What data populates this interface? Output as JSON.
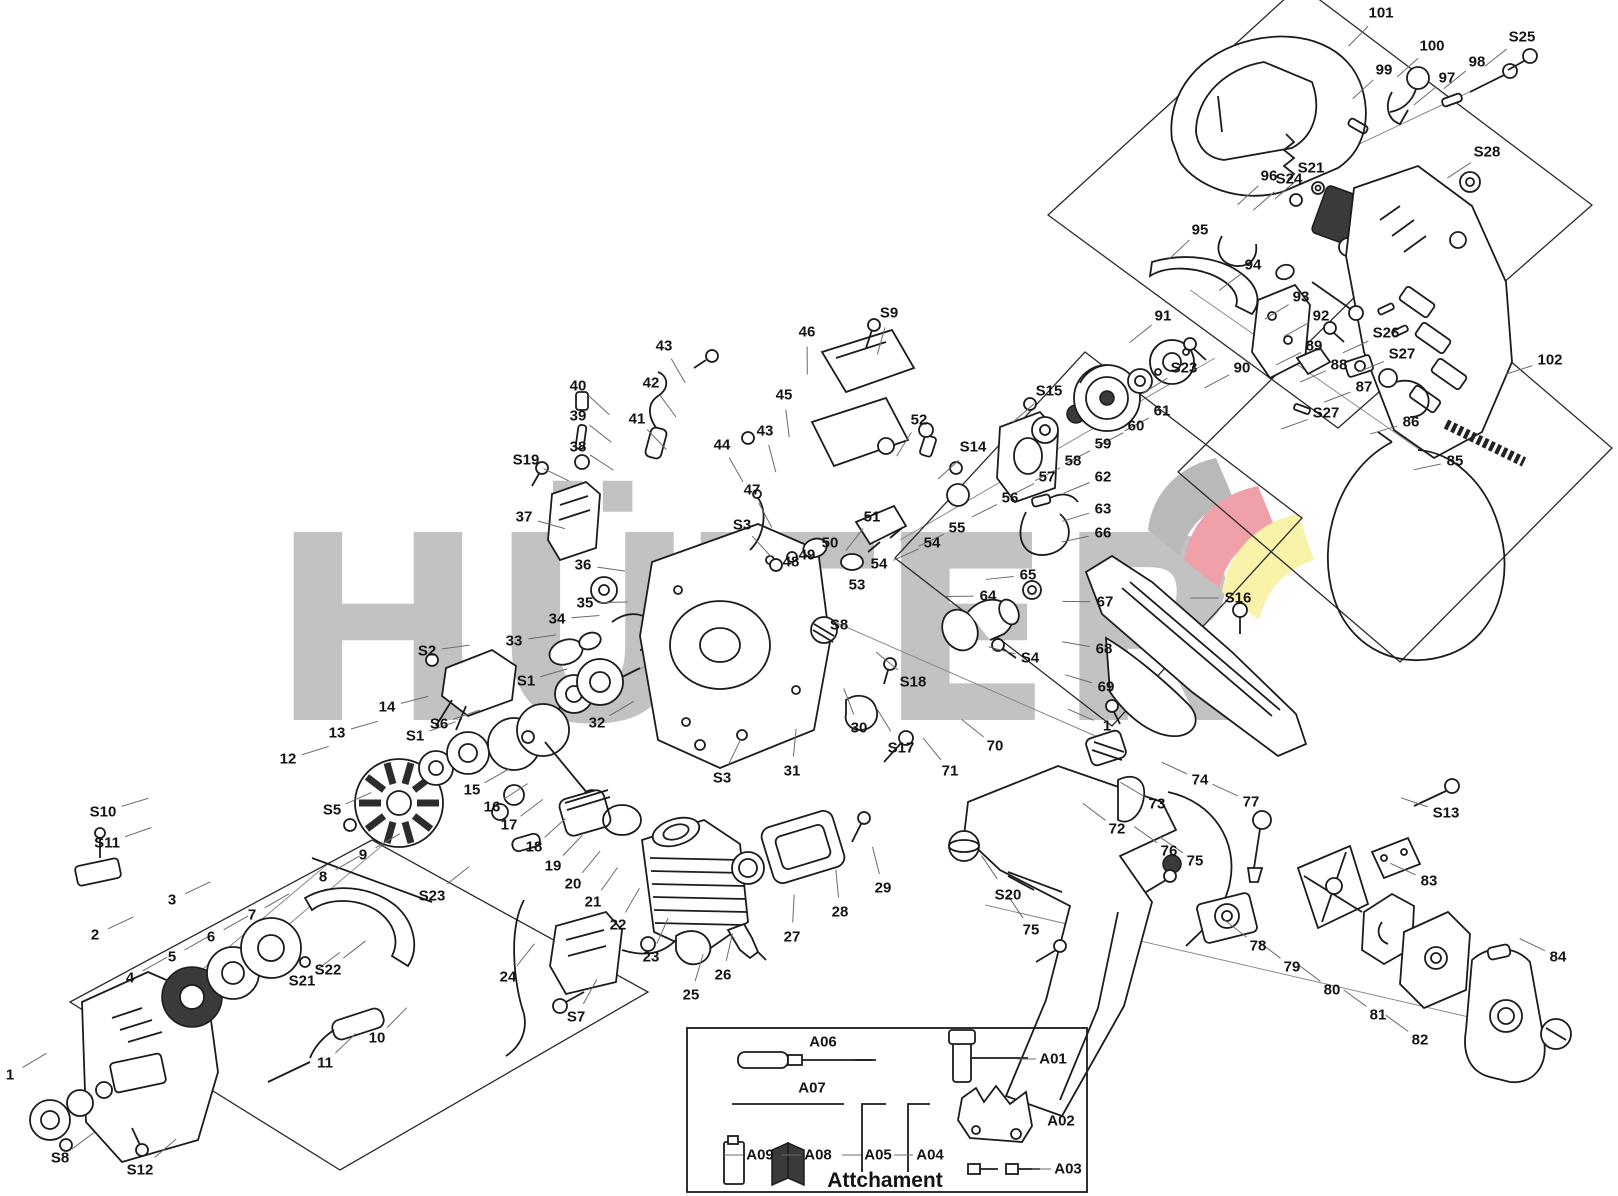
{
  "watermark": {
    "text": "HÜTER"
  },
  "logo": {
    "gray": "#b9b9b9",
    "red": "#efa0a8",
    "yellow": "#f9f2a9"
  },
  "attachment_box": {
    "title": "Attchament"
  },
  "labels": [
    {
      "t": "S10",
      "x": 103,
      "y": 812
    },
    {
      "t": "S11",
      "x": 107,
      "y": 843
    },
    {
      "t": "2",
      "x": 95,
      "y": 935
    },
    {
      "t": "3",
      "x": 172,
      "y": 900
    },
    {
      "t": "4",
      "x": 130,
      "y": 978
    },
    {
      "t": "5",
      "x": 172,
      "y": 957
    },
    {
      "t": "6",
      "x": 211,
      "y": 937
    },
    {
      "t": "7",
      "x": 252,
      "y": 915
    },
    {
      "t": "S21",
      "x": 302,
      "y": 981
    },
    {
      "t": "S22",
      "x": 328,
      "y": 970
    },
    {
      "t": "8",
      "x": 323,
      "y": 877
    },
    {
      "t": "9",
      "x": 363,
      "y": 855
    },
    {
      "t": "S23",
      "x": 432,
      "y": 896
    },
    {
      "t": "10",
      "x": 377,
      "y": 1038
    },
    {
      "t": "11",
      "x": 325,
      "y": 1063
    },
    {
      "t": "1",
      "x": 10,
      "y": 1075
    },
    {
      "t": "S8",
      "x": 60,
      "y": 1158
    },
    {
      "t": "S12",
      "x": 140,
      "y": 1170
    },
    {
      "t": "12",
      "x": 288,
      "y": 759
    },
    {
      "t": "13",
      "x": 337,
      "y": 733
    },
    {
      "t": "S5",
      "x": 332,
      "y": 810
    },
    {
      "t": "14",
      "x": 387,
      "y": 707
    },
    {
      "t": "S2",
      "x": 427,
      "y": 651
    },
    {
      "t": "S6",
      "x": 439,
      "y": 724
    },
    {
      "t": "S1",
      "x": 415,
      "y": 736
    },
    {
      "t": "S1",
      "x": 526,
      "y": 681
    },
    {
      "t": "15",
      "x": 472,
      "y": 790
    },
    {
      "t": "16",
      "x": 492,
      "y": 807
    },
    {
      "t": "17",
      "x": 509,
      "y": 825
    },
    {
      "t": "18",
      "x": 534,
      "y": 847
    },
    {
      "t": "19",
      "x": 553,
      "y": 866
    },
    {
      "t": "20",
      "x": 573,
      "y": 884
    },
    {
      "t": "21",
      "x": 593,
      "y": 902
    },
    {
      "t": "22",
      "x": 618,
      "y": 925
    },
    {
      "t": "23",
      "x": 651,
      "y": 957
    },
    {
      "t": "24",
      "x": 508,
      "y": 977
    },
    {
      "t": "25",
      "x": 691,
      "y": 995
    },
    {
      "t": "S7",
      "x": 576,
      "y": 1017
    },
    {
      "t": "26",
      "x": 723,
      "y": 975
    },
    {
      "t": "27",
      "x": 792,
      "y": 937
    },
    {
      "t": "28",
      "x": 840,
      "y": 912
    },
    {
      "t": "29",
      "x": 883,
      "y": 888
    },
    {
      "t": "32",
      "x": 597,
      "y": 723
    },
    {
      "t": "33",
      "x": 514,
      "y": 641
    },
    {
      "t": "34",
      "x": 557,
      "y": 619
    },
    {
      "t": "35",
      "x": 585,
      "y": 603
    },
    {
      "t": "36",
      "x": 583,
      "y": 565
    },
    {
      "t": "37",
      "x": 524,
      "y": 517
    },
    {
      "t": "S19",
      "x": 526,
      "y": 460
    },
    {
      "t": "38",
      "x": 578,
      "y": 447
    },
    {
      "t": "39",
      "x": 578,
      "y": 416
    },
    {
      "t": "40",
      "x": 578,
      "y": 386
    },
    {
      "t": "41",
      "x": 637,
      "y": 419
    },
    {
      "t": "42",
      "x": 651,
      "y": 383
    },
    {
      "t": "43",
      "x": 664,
      "y": 346
    },
    {
      "t": "44",
      "x": 722,
      "y": 445
    },
    {
      "t": "43",
      "x": 765,
      "y": 431
    },
    {
      "t": "45",
      "x": 784,
      "y": 395
    },
    {
      "t": "46",
      "x": 807,
      "y": 332
    },
    {
      "t": "S9",
      "x": 889,
      "y": 313
    },
    {
      "t": "47",
      "x": 752,
      "y": 490
    },
    {
      "t": "S3",
      "x": 742,
      "y": 525
    },
    {
      "t": "48",
      "x": 791,
      "y": 562
    },
    {
      "t": "49",
      "x": 807,
      "y": 555
    },
    {
      "t": "50",
      "x": 830,
      "y": 543
    },
    {
      "t": "51",
      "x": 872,
      "y": 517
    },
    {
      "t": "53",
      "x": 857,
      "y": 585
    },
    {
      "t": "54",
      "x": 879,
      "y": 564
    },
    {
      "t": "52",
      "x": 919,
      "y": 420
    },
    {
      "t": "S14",
      "x": 973,
      "y": 447
    },
    {
      "t": "54",
      "x": 932,
      "y": 543
    },
    {
      "t": "55",
      "x": 957,
      "y": 528
    },
    {
      "t": "56",
      "x": 1010,
      "y": 498
    },
    {
      "t": "57",
      "x": 1047,
      "y": 477
    },
    {
      "t": "58",
      "x": 1073,
      "y": 461
    },
    {
      "t": "59",
      "x": 1103,
      "y": 444
    },
    {
      "t": "60",
      "x": 1136,
      "y": 426
    },
    {
      "t": "61",
      "x": 1162,
      "y": 411
    },
    {
      "t": "S15",
      "x": 1049,
      "y": 391
    },
    {
      "t": "62",
      "x": 1103,
      "y": 477
    },
    {
      "t": "63",
      "x": 1103,
      "y": 509
    },
    {
      "t": "66",
      "x": 1103,
      "y": 533
    },
    {
      "t": "67",
      "x": 1105,
      "y": 602
    },
    {
      "t": "68",
      "x": 1104,
      "y": 649
    },
    {
      "t": "69",
      "x": 1106,
      "y": 687
    },
    {
      "t": "S16",
      "x": 1238,
      "y": 598
    },
    {
      "t": "64",
      "x": 988,
      "y": 596
    },
    {
      "t": "65",
      "x": 1028,
      "y": 575
    },
    {
      "t": "S4",
      "x": 1030,
      "y": 658
    },
    {
      "t": "S8",
      "x": 839,
      "y": 625
    },
    {
      "t": "S18",
      "x": 913,
      "y": 682
    },
    {
      "t": "30",
      "x": 859,
      "y": 728
    },
    {
      "t": "31",
      "x": 792,
      "y": 771
    },
    {
      "t": "S3",
      "x": 722,
      "y": 778
    },
    {
      "t": "S17",
      "x": 901,
      "y": 748
    },
    {
      "t": "70",
      "x": 995,
      "y": 746
    },
    {
      "t": "71",
      "x": 950,
      "y": 771
    },
    {
      "t": "1",
      "x": 1107,
      "y": 726
    },
    {
      "t": "74",
      "x": 1200,
      "y": 780
    },
    {
      "t": "73",
      "x": 1157,
      "y": 804
    },
    {
      "t": "72",
      "x": 1117,
      "y": 829
    },
    {
      "t": "77",
      "x": 1251,
      "y": 802
    },
    {
      "t": "76",
      "x": 1169,
      "y": 851
    },
    {
      "t": "75",
      "x": 1195,
      "y": 861
    },
    {
      "t": "S20",
      "x": 1008,
      "y": 895
    },
    {
      "t": "75",
      "x": 1031,
      "y": 930
    },
    {
      "t": "78",
      "x": 1258,
      "y": 946
    },
    {
      "t": "79",
      "x": 1292,
      "y": 967
    },
    {
      "t": "80",
      "x": 1332,
      "y": 990
    },
    {
      "t": "81",
      "x": 1378,
      "y": 1015
    },
    {
      "t": "82",
      "x": 1420,
      "y": 1040
    },
    {
      "t": "84",
      "x": 1558,
      "y": 957
    },
    {
      "t": "S13",
      "x": 1446,
      "y": 813
    },
    {
      "t": "83",
      "x": 1429,
      "y": 881
    },
    {
      "t": "101",
      "x": 1381,
      "y": 13
    },
    {
      "t": "99",
      "x": 1384,
      "y": 70
    },
    {
      "t": "100",
      "x": 1432,
      "y": 46
    },
    {
      "t": "97",
      "x": 1447,
      "y": 78
    },
    {
      "t": "98",
      "x": 1477,
      "y": 62
    },
    {
      "t": "S25",
      "x": 1522,
      "y": 37
    },
    {
      "t": "S28",
      "x": 1487,
      "y": 152
    },
    {
      "t": "96",
      "x": 1269,
      "y": 176
    },
    {
      "t": "S24",
      "x": 1289,
      "y": 179
    },
    {
      "t": "S21",
      "x": 1311,
      "y": 168
    },
    {
      "t": "95",
      "x": 1200,
      "y": 230
    },
    {
      "t": "94",
      "x": 1253,
      "y": 265
    },
    {
      "t": "93",
      "x": 1301,
      "y": 297
    },
    {
      "t": "92",
      "x": 1321,
      "y": 316
    },
    {
      "t": "S26",
      "x": 1386,
      "y": 333
    },
    {
      "t": "S27",
      "x": 1402,
      "y": 354
    },
    {
      "t": "91",
      "x": 1163,
      "y": 316
    },
    {
      "t": "S23",
      "x": 1184,
      "y": 368
    },
    {
      "t": "90",
      "x": 1242,
      "y": 368
    },
    {
      "t": "89",
      "x": 1314,
      "y": 346
    },
    {
      "t": "88",
      "x": 1339,
      "y": 365
    },
    {
      "t": "87",
      "x": 1364,
      "y": 387
    },
    {
      "t": "S27",
      "x": 1326,
      "y": 413
    },
    {
      "t": "86",
      "x": 1411,
      "y": 422
    },
    {
      "t": "85",
      "x": 1455,
      "y": 461
    },
    {
      "t": "102",
      "x": 1550,
      "y": 360
    },
    {
      "t": "A06",
      "x": 823,
      "y": 1042,
      "lead": "n"
    },
    {
      "t": "A07",
      "x": 812,
      "y": 1088,
      "lead": "n"
    },
    {
      "t": "A09",
      "x": 760,
      "y": 1155,
      "lead": "l"
    },
    {
      "t": "A08",
      "x": 818,
      "y": 1155,
      "lead": "l"
    },
    {
      "t": "A05",
      "x": 878,
      "y": 1155,
      "lead": "l"
    },
    {
      "t": "A04",
      "x": 930,
      "y": 1155,
      "lead": "l"
    },
    {
      "t": "A01",
      "x": 1053,
      "y": 1059,
      "lead": "l"
    },
    {
      "t": "A02",
      "x": 1061,
      "y": 1121,
      "lead": "n"
    },
    {
      "t": "A03",
      "x": 1068,
      "y": 1169,
      "lead": "l"
    }
  ]
}
